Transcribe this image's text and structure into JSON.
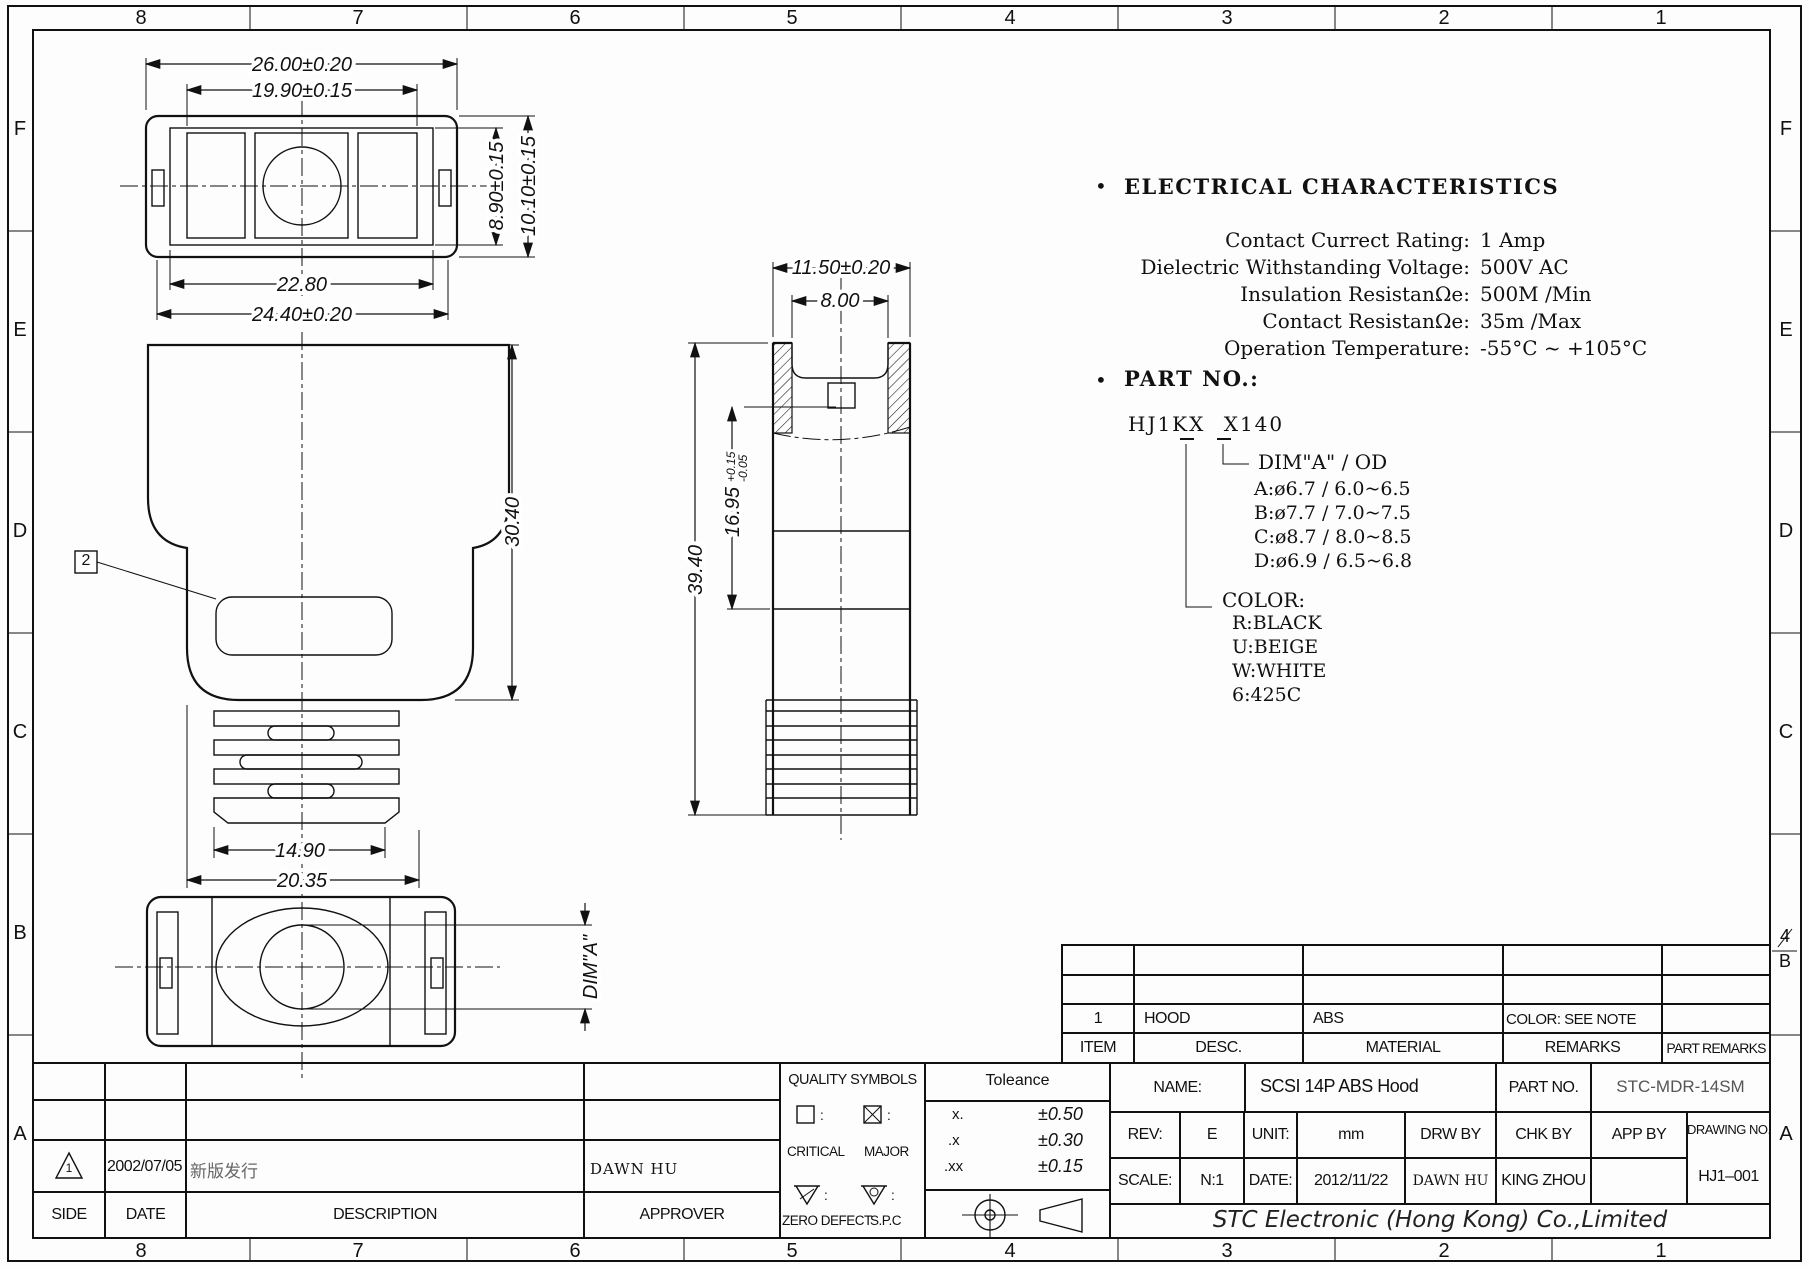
{
  "border": {
    "top_numbers": [
      "8",
      "7",
      "6",
      "5",
      "4",
      "3",
      "2",
      "1"
    ],
    "bottom_numbers": [
      "8",
      "7",
      "6",
      "5",
      "4",
      "3",
      "2",
      "1"
    ],
    "left_letters": [
      "F",
      "E",
      "D",
      "C",
      "B",
      "A"
    ],
    "right_letters": [
      "F",
      "E",
      "D",
      "C",
      "A"
    ],
    "zone_marker": {
      "rev": "4",
      "zone": "B"
    }
  },
  "dims": {
    "top_view": {
      "width_outer": "26.00±0.20",
      "width_window": "19.90±0.15",
      "width_inner": "22.80",
      "width_body": "24.40±0.20",
      "height_inner": "8.90±0.15",
      "height_outer": "10.10±0.15"
    },
    "front_view": {
      "height_hood": "30.40",
      "width_ribs": "14.90",
      "width_bottom": "20.35",
      "balloon": "2"
    },
    "side_view": {
      "width_outer": "11.50±0.20",
      "width_cavity": "8.00",
      "height_mid": "16.95",
      "tol_plus": "+0.15",
      "tol_minus": "-0.05",
      "height_total": "39.40"
    },
    "bottom_view": {
      "dim_a": "DIM\"A\""
    }
  },
  "electrical": {
    "bullet": "•",
    "title": "ELECTRICAL  CHARACTERISTICS",
    "rows": [
      {
        "label": "Contact  Currect  Rating:",
        "value": "1  Amp"
      },
      {
        "label": "Dielectric  Withstanding  Voltage:",
        "value": "500V  AC"
      },
      {
        "label": "Insulation  ResistanΩe:",
        "value": "500M  /Min"
      },
      {
        "label": "Contact  ResistanΩe:",
        "value": "35m  /Max"
      },
      {
        "label": "Operation  Temperature:",
        "value": "-55°C  ~  +105°C"
      }
    ]
  },
  "part_no": {
    "bullet": "•",
    "title": "PART  NO.:",
    "code": "HJ1KX X140",
    "dim_header": "DIM\"A\"  /  OD",
    "dim_rows": [
      "A:ø6.7  /  6.0~6.5",
      "B:ø7.7  /  7.0~7.5",
      "C:ø8.7  /  8.0~8.5",
      "D:ø6.9  /  6.5~6.8"
    ],
    "color_header": "COLOR:",
    "color_rows": [
      "R:BLACK",
      "U:BEIGE",
      "W:WHITE",
      "6:425C"
    ]
  },
  "revision_table": {
    "headers": [
      "SIDE",
      "DATE",
      "DESCRIPTION",
      "APPROVER"
    ],
    "row": {
      "side_mark": "1",
      "date": "2002/07/05",
      "description": "新版发行",
      "approver": "DAWN HU"
    }
  },
  "quality_symbols": {
    "title": "QUALITY  SYMBOLS",
    "colon": ":",
    "critical_label": "CRITICAL",
    "major_label": "MAJOR",
    "zero_defect_label": "ZERO  DEFECT",
    "spc_label": "S.P.C",
    "tri_left_letter": "Z",
    "tri_right_letter": "C"
  },
  "tolerance": {
    "title": "Toleance",
    "rows": [
      {
        "digits": "x.",
        "value": "±0.50"
      },
      {
        "digits": ".x",
        "value": "±0.30"
      },
      {
        "digits": ".xx",
        "value": "±0.15"
      }
    ]
  },
  "item_table": {
    "headers": [
      "ITEM",
      "DESC.",
      "MATERIAL",
      "REMARKS",
      "PART REMARKS"
    ],
    "row": {
      "item": "1",
      "desc": "HOOD",
      "material": "ABS",
      "remarks": "COLOR: SEE NOTE",
      "part_remarks": ""
    }
  },
  "title_block": {
    "name_label": "NAME:",
    "name": "SCSI  14P  ABS  Hood",
    "part_no_label": "PART  NO.",
    "part_no": "STC-MDR-14SM",
    "rev_label": "REV:",
    "rev": "E",
    "unit_label": "UNIT:",
    "unit": "mm",
    "drw_by_label": "DRW  BY",
    "chk_by_label": "CHK  BY",
    "app_by_label": "APP  BY",
    "drawing_no_label": "DRAWING  NO.",
    "scale_label": "SCALE:",
    "scale": "N:1",
    "date_label": "DATE:",
    "date": "2012/11/22",
    "drw_by": "DAWN  HU",
    "chk_by": "KING  ZHOU",
    "app_by": "",
    "drawing_no": "HJ1–001",
    "company": "STC Electronic (Hong Kong) Co.,Limited"
  }
}
